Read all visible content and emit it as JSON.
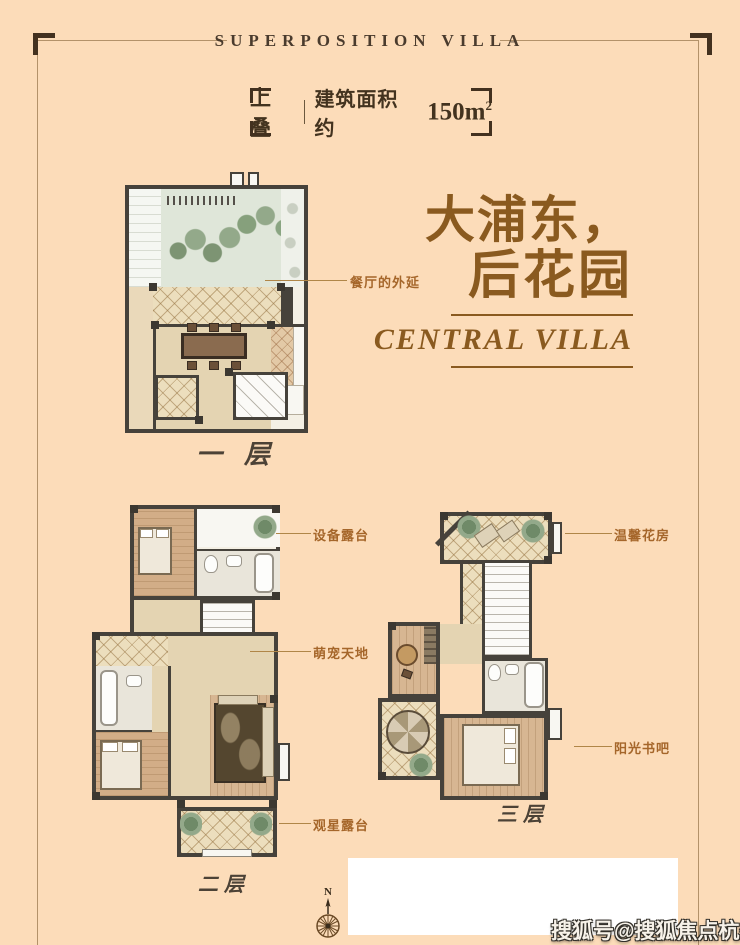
{
  "page": {
    "bg_color": "#fcdcb9",
    "accent_color": "#8a5a1f",
    "label_color": "#a5662a",
    "wall_color": "#46423b"
  },
  "header": {
    "title": "SUPERPOSITION VILLA"
  },
  "badge": {
    "type": "上叠",
    "area_label": "建筑面积约",
    "area_value": "150m",
    "area_sup": "2"
  },
  "headline": {
    "line1": "大浦东，",
    "line2": "后花园",
    "subtitle": "CENTRAL VILLA"
  },
  "floors": {
    "floor1": {
      "caption": "一层",
      "label_dining": "餐厅的外延"
    },
    "floor2": {
      "caption": "二层",
      "label_equipment": "设备露台",
      "label_pet": "萌宠天地",
      "label_star": "观星露台"
    },
    "floor3": {
      "caption": "三层",
      "label_flower": "温馨花房",
      "label_sun": "阳光书吧"
    }
  },
  "compass": {
    "letter": "N"
  },
  "watermark": {
    "text": "搜狐号@搜狐焦点杭州站"
  }
}
